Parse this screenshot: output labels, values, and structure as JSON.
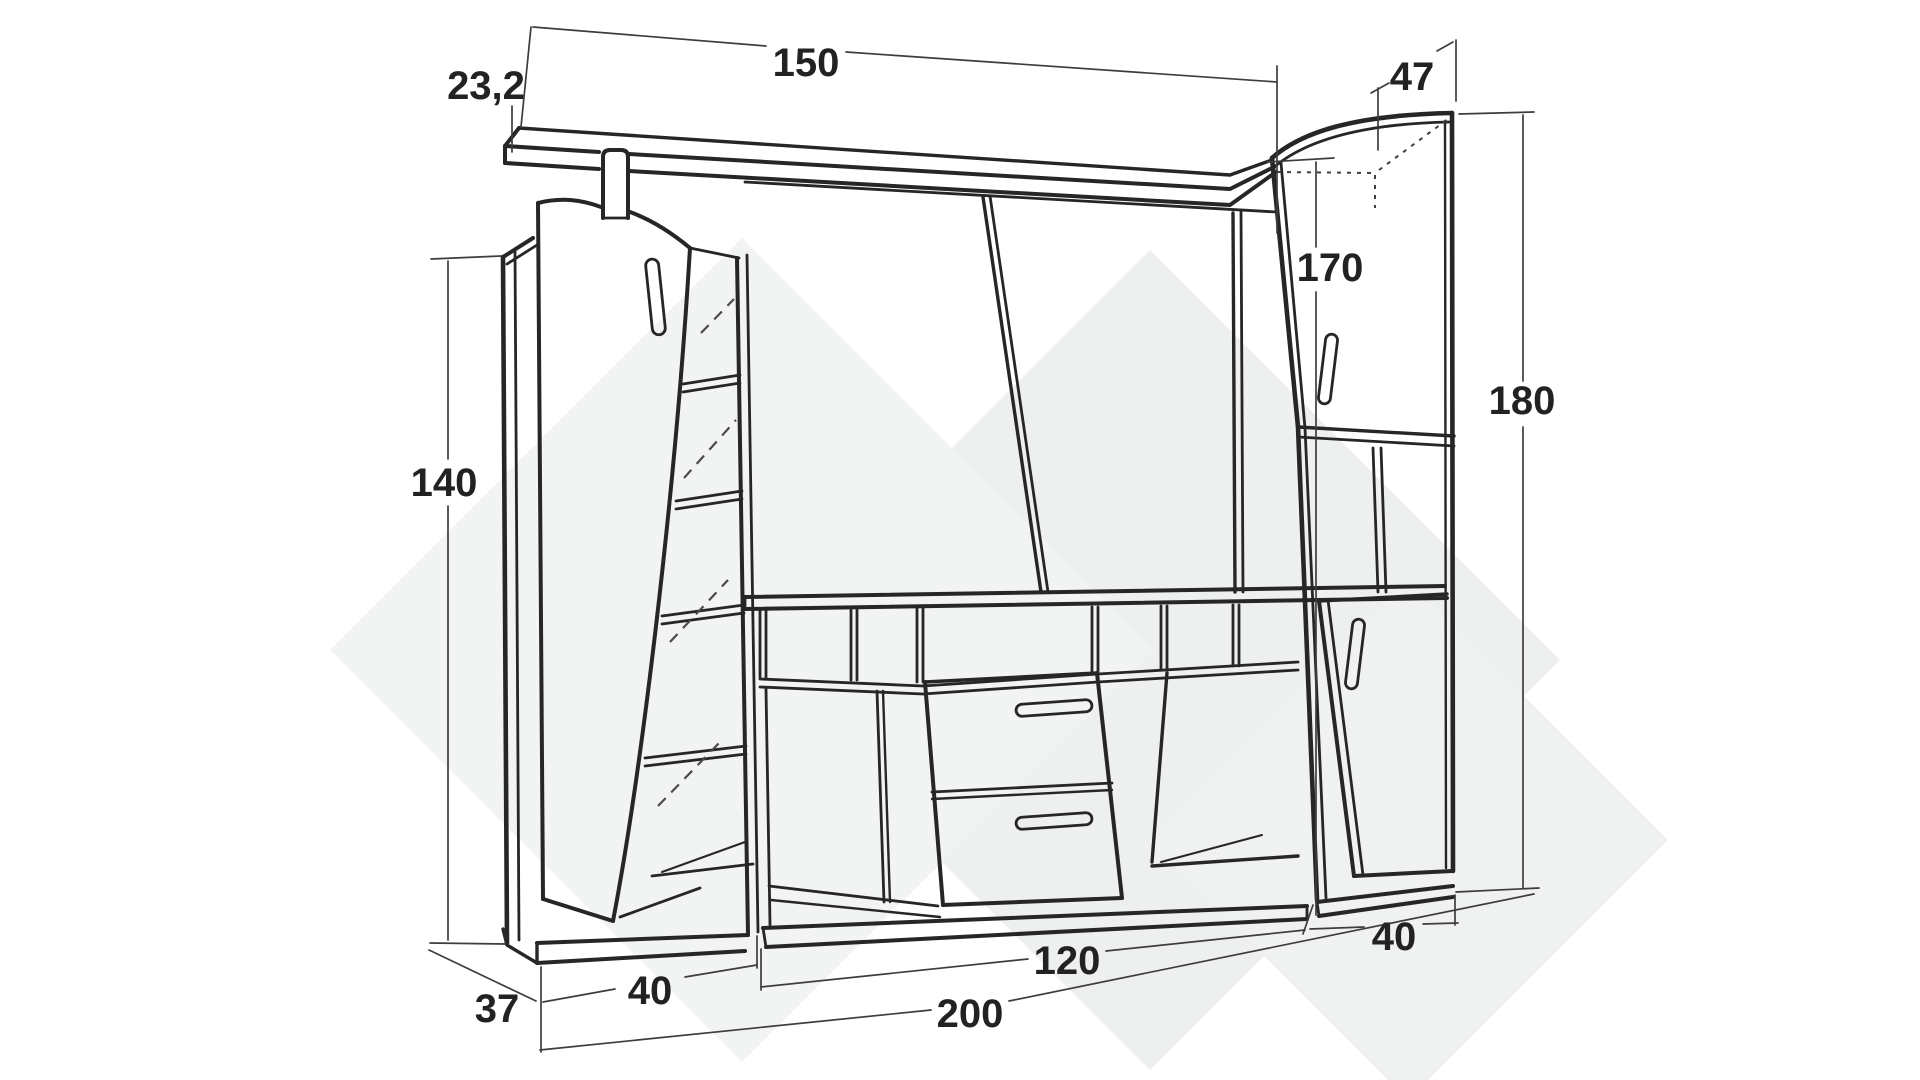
{
  "drawing": {
    "type": "furniture-dimension-diagram",
    "subject": "wall unit with left cabinet, open mirrored door, center shelf, drawer unit and right cabinets",
    "colors": {
      "line": "#262626",
      "dimension_line": "#3d3d3d",
      "label_text": "#222222",
      "watermark": "#f0f1f1",
      "background": "#ffffff"
    },
    "dimensions": {
      "shelf_overhang": "23,2",
      "shelf_length": "150",
      "right_cabinet_depth": "47",
      "right_section_height": "170",
      "total_height": "180",
      "left_cabinet_height": "140",
      "left_cabinet_depth": "37",
      "left_cabinet_width": "40",
      "center_section_width": "120",
      "right_cabinet_width": "40",
      "total_width": "200"
    }
  }
}
